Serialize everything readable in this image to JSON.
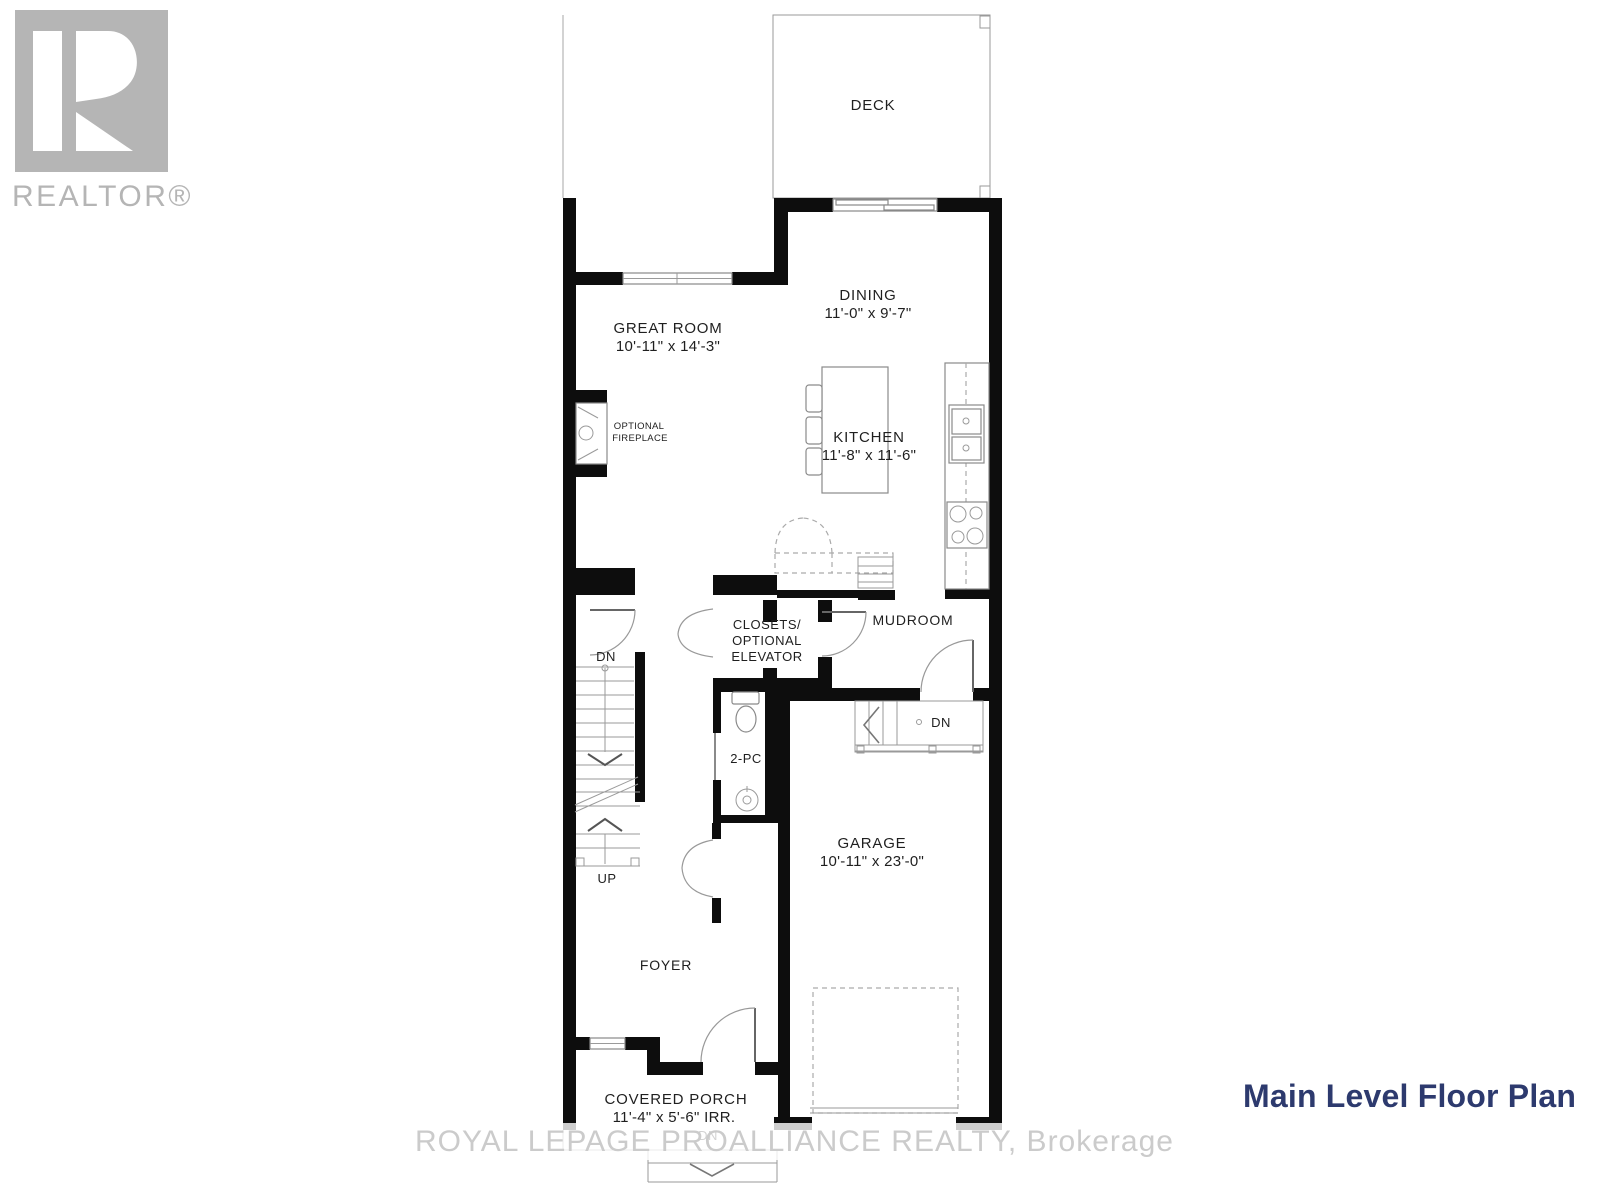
{
  "branding": {
    "realtor_logo_text": "REALTOR®"
  },
  "watermark": {
    "text": "ROYAL LEPAGE PROALLIANCE REALTY, Brokerage"
  },
  "title": {
    "text": "Main Level Floor Plan",
    "color": "#2d3a6e"
  },
  "rooms": {
    "deck": {
      "name": "DECK"
    },
    "great_room": {
      "name": "GREAT ROOM",
      "dimensions": "10'-11\" x 14'-3\""
    },
    "dining": {
      "name": "DINING",
      "dimensions": "11'-0\" x 9'-7\""
    },
    "kitchen": {
      "name": "KITCHEN",
      "dimensions": "11'-8\" x 11'-6\""
    },
    "fireplace": {
      "line1": "OPTIONAL",
      "line2": "FIREPLACE"
    },
    "closets": {
      "line1": "CLOSETS/",
      "line2": "OPTIONAL",
      "line3": "ELEVATOR"
    },
    "mudroom": {
      "name": "MUDROOM"
    },
    "bath": {
      "name": "2-PC"
    },
    "garage": {
      "name": "GARAGE",
      "dimensions": "10'-11\" x 23'-0\""
    },
    "foyer": {
      "name": "FOYER"
    },
    "covered_porch": {
      "name": "COVERED PORCH",
      "dimensions": "11'-4\" x 5'-6\" IRR."
    }
  },
  "stair_labels": {
    "dn_main": "DN",
    "up_main": "UP",
    "dn_garage": "DN",
    "dn_porch": "DN"
  }
}
